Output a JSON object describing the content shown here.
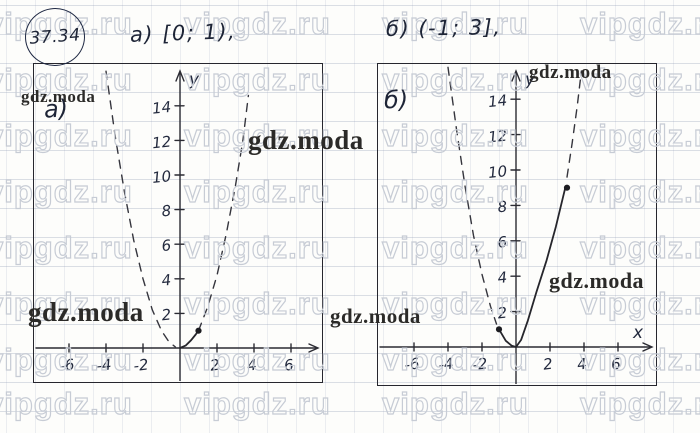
{
  "page": {
    "problem_number": "37.34",
    "part_a_text": "а) [0; 1),",
    "part_b_text": "б) (-1; 3],"
  },
  "colors": {
    "ink": "#1d2436",
    "curve": "#26262c",
    "frame": "#26262e",
    "grid_line": "#94a0b8",
    "watermark_outline": "#c7ccd5",
    "watermark_dark": "#2b2a28"
  },
  "watermarks": {
    "outline_text": "vipgdz.ru",
    "solid_text": "gdz.moda",
    "grid": {
      "cols": [
        -14,
        184,
        382,
        580
      ],
      "rows": [
        6,
        62,
        118,
        174,
        230,
        286,
        342,
        386
      ]
    },
    "solid_marks": [
      {
        "x": 21,
        "y": 88,
        "size": 17
      },
      {
        "x": 248,
        "y": 127,
        "size": 27
      },
      {
        "x": 529,
        "y": 63,
        "size": 19
      },
      {
        "x": 28,
        "y": 299,
        "size": 27
      },
      {
        "x": 330,
        "y": 306,
        "size": 21
      },
      {
        "x": 549,
        "y": 270,
        "size": 22
      }
    ]
  },
  "chart_data": [
    {
      "id": "a",
      "type": "line",
      "title": "а)",
      "corner_label": "а)",
      "interval_label": "[0; 1)",
      "xlabel": "",
      "ylabel": "y",
      "xlim": [
        -8,
        7.7
      ],
      "ylim": [
        -2,
        16.5
      ],
      "grid": false,
      "x_ticks": [
        -6,
        -4,
        -2,
        2,
        4,
        6
      ],
      "y_ticks": [
        2,
        4,
        6,
        8,
        10,
        12,
        14
      ],
      "px": {
        "w": 287,
        "h": 317,
        "ox": 146,
        "oy": 284,
        "ux": 18.5,
        "uy": 17.3
      },
      "segments": [
        {
          "style": "dashed",
          "points": [
            [
              -4,
              16
            ],
            [
              -3.5,
              12.2
            ],
            [
              -3,
              9
            ],
            [
              -2.5,
              6.2
            ],
            [
              -2,
              4
            ],
            [
              -1.5,
              2.2
            ],
            [
              -1,
              1
            ],
            [
              -0.6,
              0.36
            ],
            [
              -0.25,
              0.06
            ]
          ]
        },
        {
          "style": "solid",
          "points": [
            [
              0,
              0
            ],
            [
              0.3,
              0.14
            ],
            [
              0.6,
              0.45
            ],
            [
              0.85,
              0.78
            ],
            [
              1,
              1
            ]
          ]
        },
        {
          "style": "dashed",
          "points": [
            [
              1,
              1
            ],
            [
              1.5,
              2.4
            ],
            [
              2,
              4.2
            ],
            [
              2.5,
              6.6
            ],
            [
              3,
              9.4
            ],
            [
              3.4,
              12
            ],
            [
              3.7,
              14.6
            ]
          ]
        }
      ],
      "points": [
        {
          "x": 1,
          "y": 1
        }
      ]
    },
    {
      "id": "b",
      "type": "line",
      "title": "б)",
      "corner_label": "б)",
      "interval_label": "(-1; 3]",
      "xlabel": "x",
      "ylabel": "y",
      "xlim": [
        -8.1,
        8.2
      ],
      "ylim": [
        -2.1,
        16
      ],
      "grid": false,
      "x_ticks": [
        -6,
        -4,
        -2,
        2,
        4,
        6
      ],
      "y_ticks": [
        2,
        4,
        6,
        8,
        10,
        12,
        14
      ],
      "px": {
        "w": 277,
        "h": 320,
        "ox": 138,
        "oy": 283,
        "ux": 17,
        "uy": 17.7
      },
      "segments": [
        {
          "style": "dashed",
          "points": [
            [
              -4,
              15.8
            ],
            [
              -3.5,
              12.3
            ],
            [
              -3,
              9.1
            ],
            [
              -2.5,
              6.3
            ],
            [
              -2,
              4.1
            ],
            [
              -1.5,
              2.3
            ],
            [
              -1.15,
              1.3
            ]
          ]
        },
        {
          "style": "solid",
          "points": [
            [
              -1,
              1
            ],
            [
              -0.6,
              0.35
            ],
            [
              -0.25,
              0.07
            ],
            [
              0,
              0
            ],
            [
              0.3,
              0.4
            ],
            [
              0.7,
              1.5
            ],
            [
              1.2,
              3.1
            ],
            [
              1.8,
              4.9
            ],
            [
              2.35,
              6.8
            ],
            [
              2.9,
              9
            ]
          ]
        },
        {
          "style": "dashed",
          "points": [
            [
              3,
              9.6
            ],
            [
              3.3,
              11.5
            ],
            [
              3.6,
              13.6
            ],
            [
              3.85,
              15.6
            ]
          ]
        }
      ],
      "points": [
        {
          "x": -1,
          "y": 1
        },
        {
          "x": 3,
          "y": 9
        }
      ]
    }
  ]
}
